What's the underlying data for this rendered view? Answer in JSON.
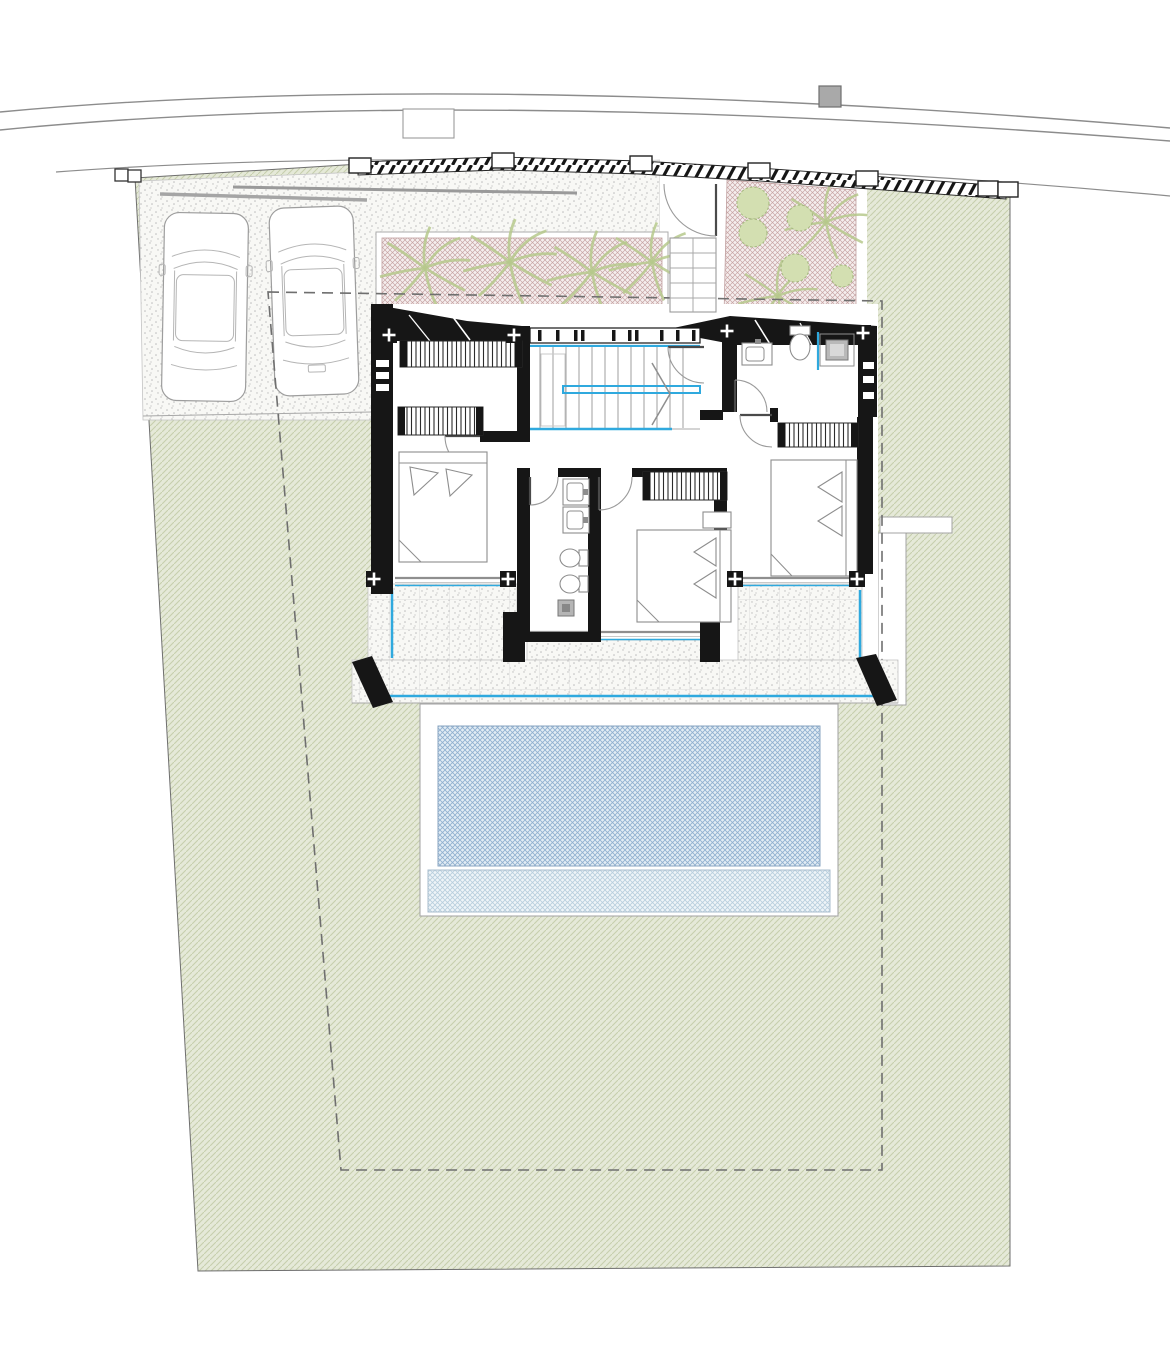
{
  "drawing": {
    "kind": "architectural-site-and-floor-plan",
    "floor": "upper floor with pool garden",
    "text_labels": [],
    "rooms": [
      {
        "name": "bedroom-left",
        "furniture": [
          "double-bed",
          "wardrobe",
          "wardrobe"
        ]
      },
      {
        "name": "bedroom-middle",
        "furniture": [
          "double-bed",
          "wardrobe",
          "side-table"
        ]
      },
      {
        "name": "bedroom-right",
        "furniture": [
          "double-bed",
          "wardrobe"
        ]
      },
      {
        "name": "bathroom-central",
        "furniture": [
          "double-vanity",
          "wc",
          "bidet",
          "shower"
        ]
      },
      {
        "name": "bathroom-top-right",
        "furniture": [
          "vanity",
          "wc",
          "shower"
        ]
      },
      {
        "name": "stair-hall",
        "furniture": [
          "u-stair-with-blue-rails"
        ]
      }
    ],
    "site_features": {
      "cars": 2,
      "parking_surface": "stippled paving",
      "planters": 2,
      "bushes": 5,
      "pool": {
        "zones": [
          "deep-crosshatch",
          "shallow-shelf"
        ]
      },
      "boundary": [
        "curved road",
        "hatched boundary wall with posts",
        "dashed setback line"
      ],
      "terrace": "stippled deck with glass balustrade"
    }
  },
  "colors": {
    "accent": "#2fa9de",
    "wall": "#161616",
    "line_grey": "#9a9a9a",
    "road": "#8c8c8c",
    "dash": "#6f6f6f",
    "lawn_bg": "#e5e9d8",
    "lawn_line": "#c6cfad",
    "stipple_bg": "#f8f8f5",
    "stipple_dot": "#bcbcbc",
    "planter_bg": "#f5eeee",
    "planter_line": "#c7a4a4",
    "plant_green": "#b6c98c",
    "bush_fill": "#d3dfb1",
    "bush_line": "#a6ba80",
    "pool_bg": "#e2ecf4",
    "pool_line": "#8fafcf",
    "pool_shallow_bg": "#eef4f8",
    "pool_shallow_line": "#b7cedd",
    "utility_box": "#a9a9a9"
  }
}
